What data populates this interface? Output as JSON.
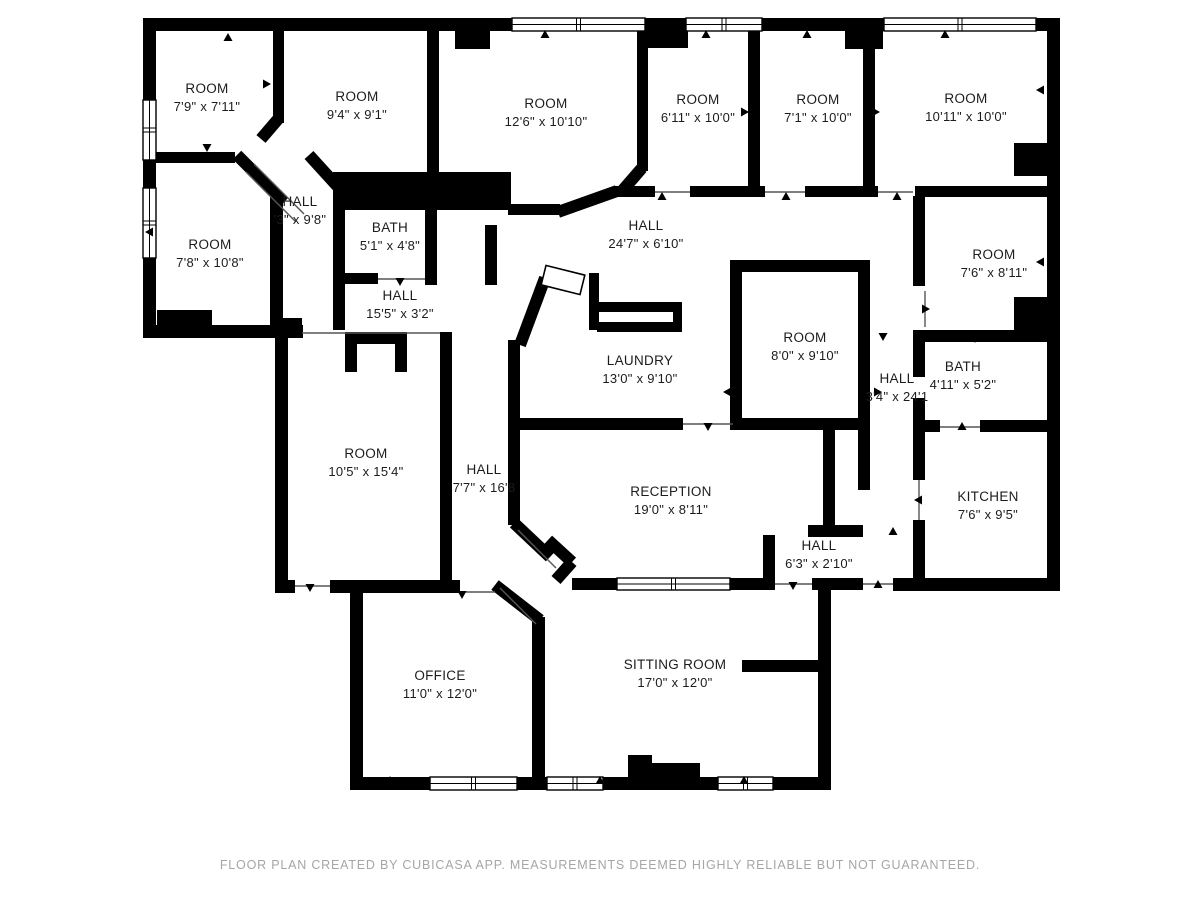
{
  "footer": {
    "text": "FLOOR PLAN CREATED BY CUBICASA APP. MEASUREMENTS DEEMED HIGHLY RELIABLE BUT NOT GUARANTEED."
  },
  "colors": {
    "wall": "#000000",
    "background": "#ffffff",
    "label_text": "#1c1c1c",
    "footer_text": "#a6a6a6"
  },
  "rooms": [
    {
      "id": "room-1",
      "name": "ROOM",
      "dims": "7'9\" x 7'11\""
    },
    {
      "id": "room-2",
      "name": "ROOM",
      "dims": "9'4\" x 9'1\""
    },
    {
      "id": "room-3",
      "name": "ROOM",
      "dims": "12'6\" x 10'10\""
    },
    {
      "id": "room-4",
      "name": "ROOM",
      "dims": "6'11\" x 10'0\""
    },
    {
      "id": "room-5",
      "name": "ROOM",
      "dims": "7'1\" x 10'0\""
    },
    {
      "id": "room-6",
      "name": "ROOM",
      "dims": "10'11\" x 10'0\""
    },
    {
      "id": "hall-upper",
      "name": "HALL",
      "dims": "'3\" x 9'8\""
    },
    {
      "id": "room-7",
      "name": "ROOM",
      "dims": "7'8\" x 10'8\""
    },
    {
      "id": "bath-1",
      "name": "BATH",
      "dims": "5'1\" x 4'8\""
    },
    {
      "id": "hall-15",
      "name": "HALL",
      "dims": "15'5\" x 3'2\""
    },
    {
      "id": "hall-24",
      "name": "HALL",
      "dims": "24'7\" x 6'10\""
    },
    {
      "id": "room-8",
      "name": "ROOM",
      "dims": "7'6\" x 8'11\""
    },
    {
      "id": "laundry",
      "name": "LAUNDRY",
      "dims": "13'0\" x 9'10\""
    },
    {
      "id": "room-9",
      "name": "ROOM",
      "dims": "8'0\" x 9'10\""
    },
    {
      "id": "hall-34",
      "name": "HALL",
      "dims": "3'4\" x 24'1"
    },
    {
      "id": "bath-2",
      "name": "BATH",
      "dims": "4'11\" x 5'2\""
    },
    {
      "id": "room-10",
      "name": "ROOM",
      "dims": "10'5\" x 15'4\""
    },
    {
      "id": "hall-77",
      "name": "HALL",
      "dims": "7'7\" x 16'8"
    },
    {
      "id": "reception",
      "name": "RECEPTION",
      "dims": "19'0\" x 8'11\""
    },
    {
      "id": "hall-63",
      "name": "HALL",
      "dims": "6'3\" x 2'10\""
    },
    {
      "id": "kitchen",
      "name": "KITCHEN",
      "dims": "7'6\" x 9'5\""
    },
    {
      "id": "office",
      "name": "OFFICE",
      "dims": "11'0\" x 12'0\""
    },
    {
      "id": "sitting",
      "name": "SITTING ROOM",
      "dims": "17'0\" x 12'0\""
    }
  ]
}
